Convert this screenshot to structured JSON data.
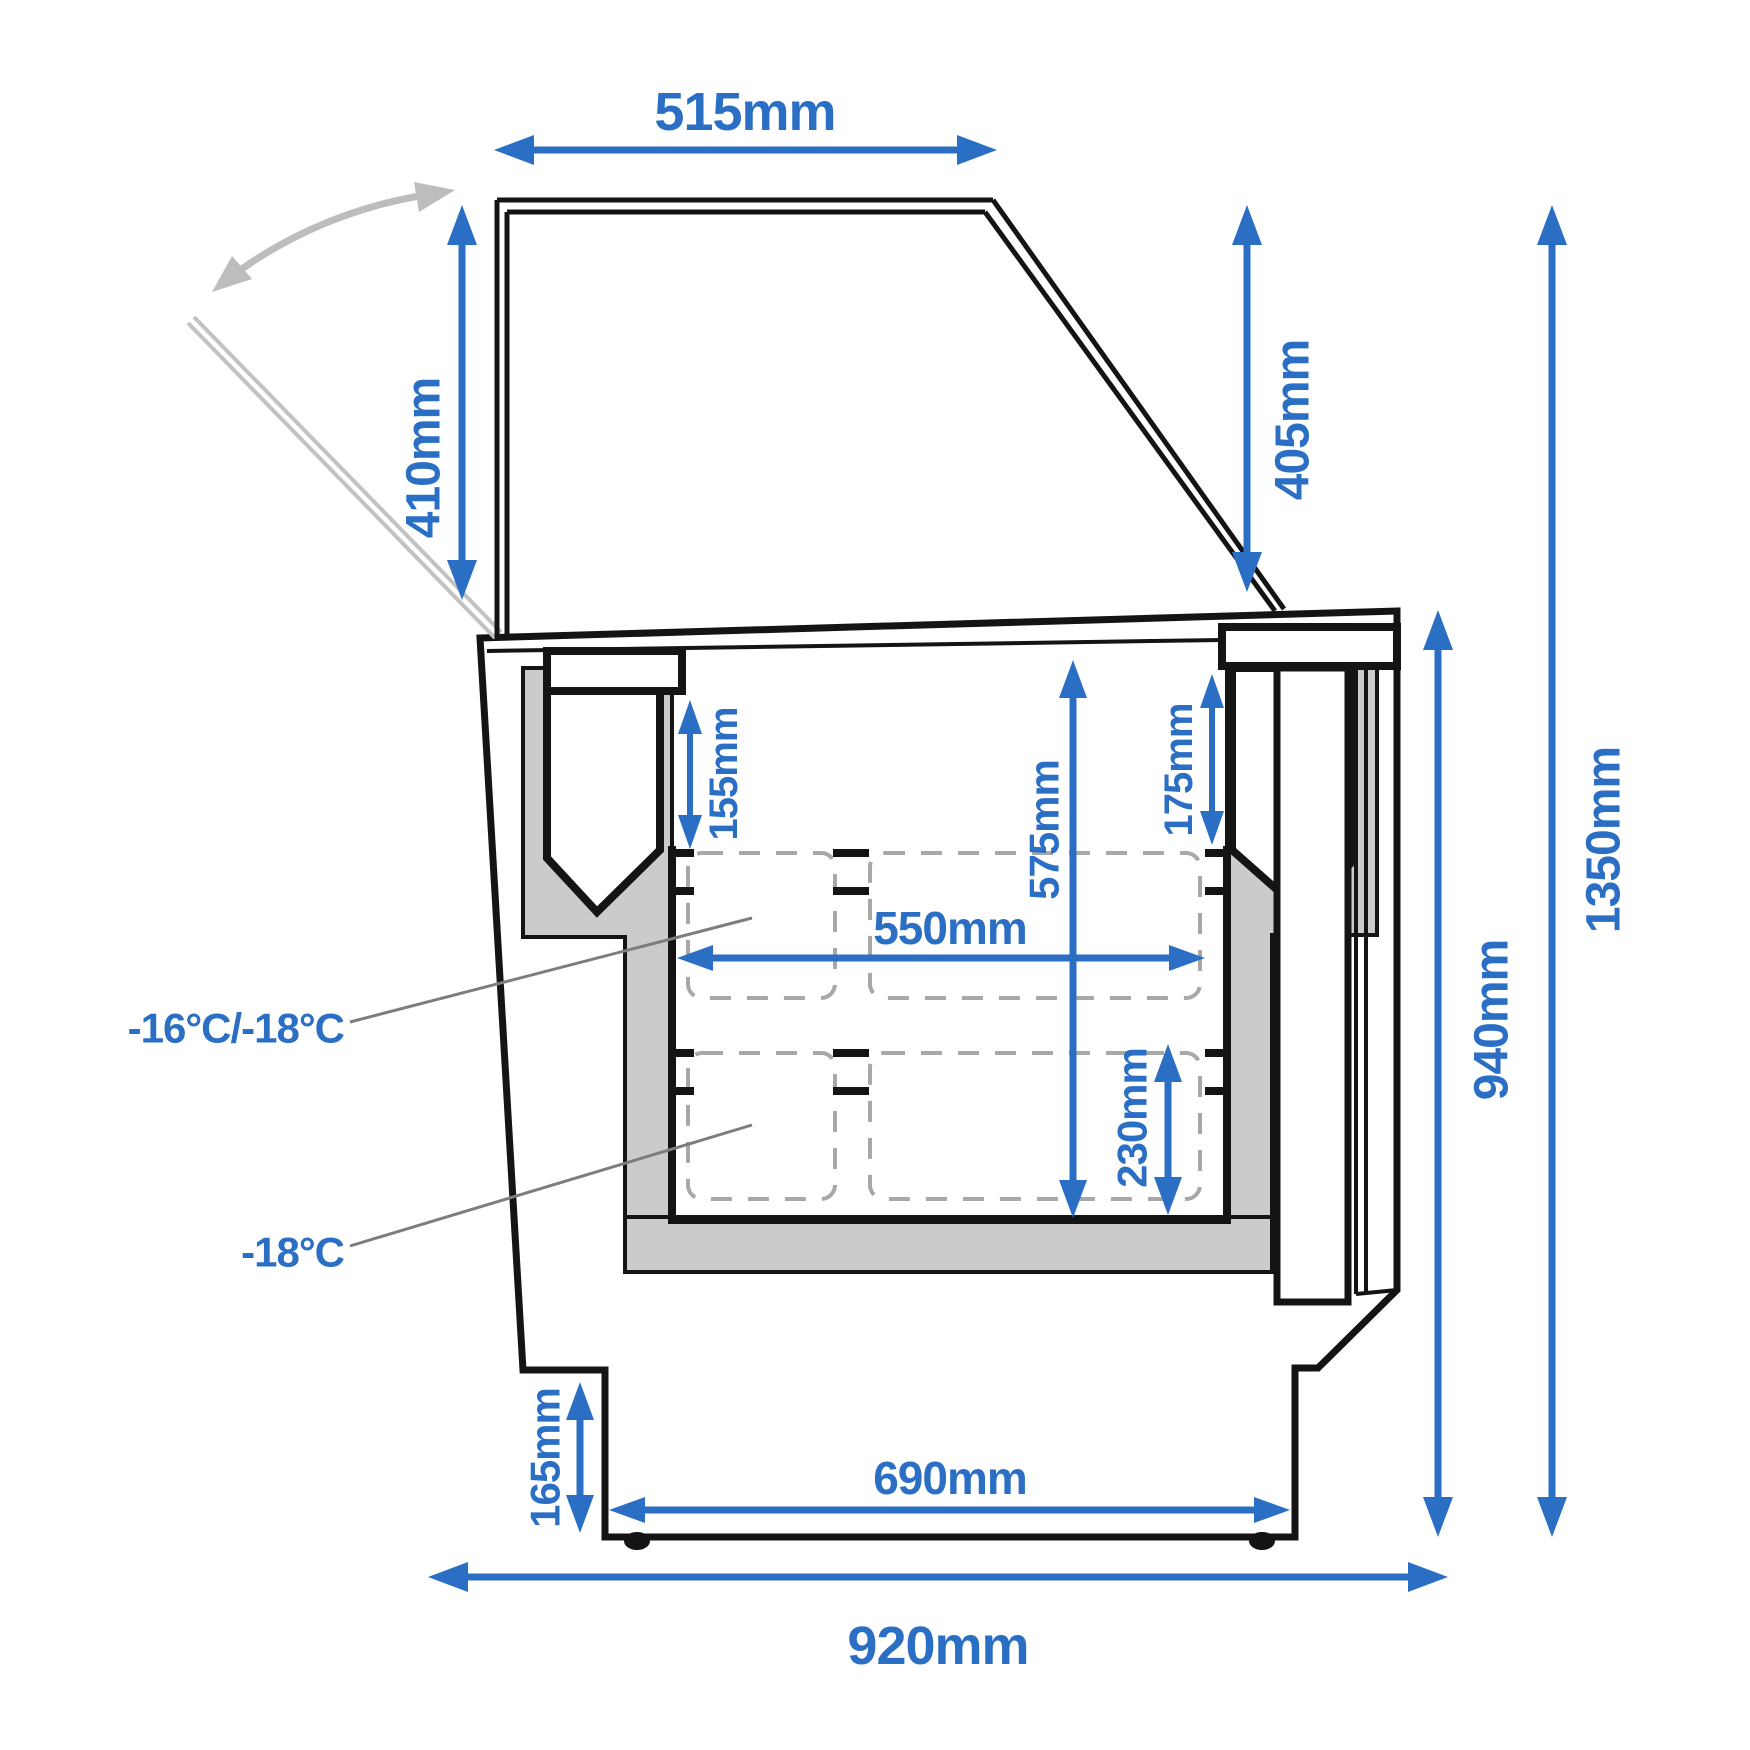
{
  "diagram": {
    "type": "freezer cross-section dimensional drawing",
    "units": "mm"
  },
  "dimensions": {
    "top_width": {
      "label": "515mm"
    },
    "lid_height_left": {
      "label": "410mm"
    },
    "lid_height_right": {
      "label": "405mm"
    },
    "total_height": {
      "label": "1350mm"
    },
    "body_height": {
      "label": "940mm"
    },
    "rim_to_basket_left": {
      "label": "155mm"
    },
    "rim_to_basket_right": {
      "label": "175mm"
    },
    "inner_depth": {
      "label": "575mm"
    },
    "inner_width": {
      "label": "550mm"
    },
    "lower_basket_depth": {
      "label": "230mm"
    },
    "base_recess_height": {
      "label": "165mm"
    },
    "base_width": {
      "label": "690mm"
    },
    "total_width": {
      "label": "920mm"
    }
  },
  "temperature_labels": {
    "upper_zone": "-16°C/-18°C",
    "lower_zone": "-18°C"
  },
  "colors": {
    "dimension_blue": "#2b6fc5",
    "insulation_gray": "#cbcbcb",
    "basket_dash_gray": "#a8a8a8",
    "swing_hint_gray": "#bdbdbd",
    "outline_black": "#141414"
  }
}
